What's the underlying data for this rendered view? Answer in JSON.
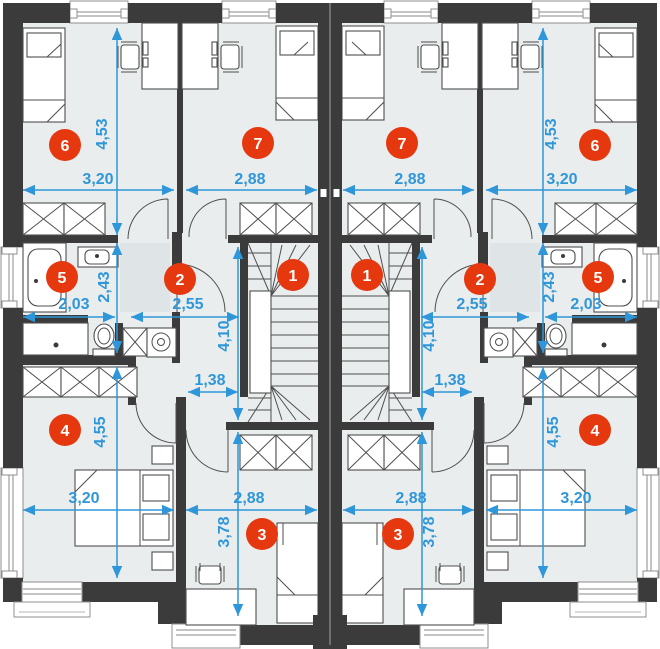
{
  "rooms": {
    "n1": "1",
    "n2": "2",
    "n3": "3",
    "n4": "4",
    "n5": "5",
    "n6": "6",
    "n7": "7"
  },
  "dims": {
    "v453": "4,53",
    "v243": "2,43",
    "v455": "4,55",
    "v410": "4,10",
    "v378": "3,78",
    "h320": "3,20",
    "h288": "2,88",
    "h203": "2,03",
    "h255": "2,55",
    "h138": "1,38"
  },
  "colors": {
    "wall": "#3b3b3b",
    "floor": "#e9edee",
    "furniture_outline": "#4f4f4f",
    "dimension_blue": "#2f97d9",
    "marker_red": "#e6380f",
    "background": "#ffffff",
    "shower_gray": "#dfe5e6",
    "bay_stroke": "#8f8f8f"
  }
}
